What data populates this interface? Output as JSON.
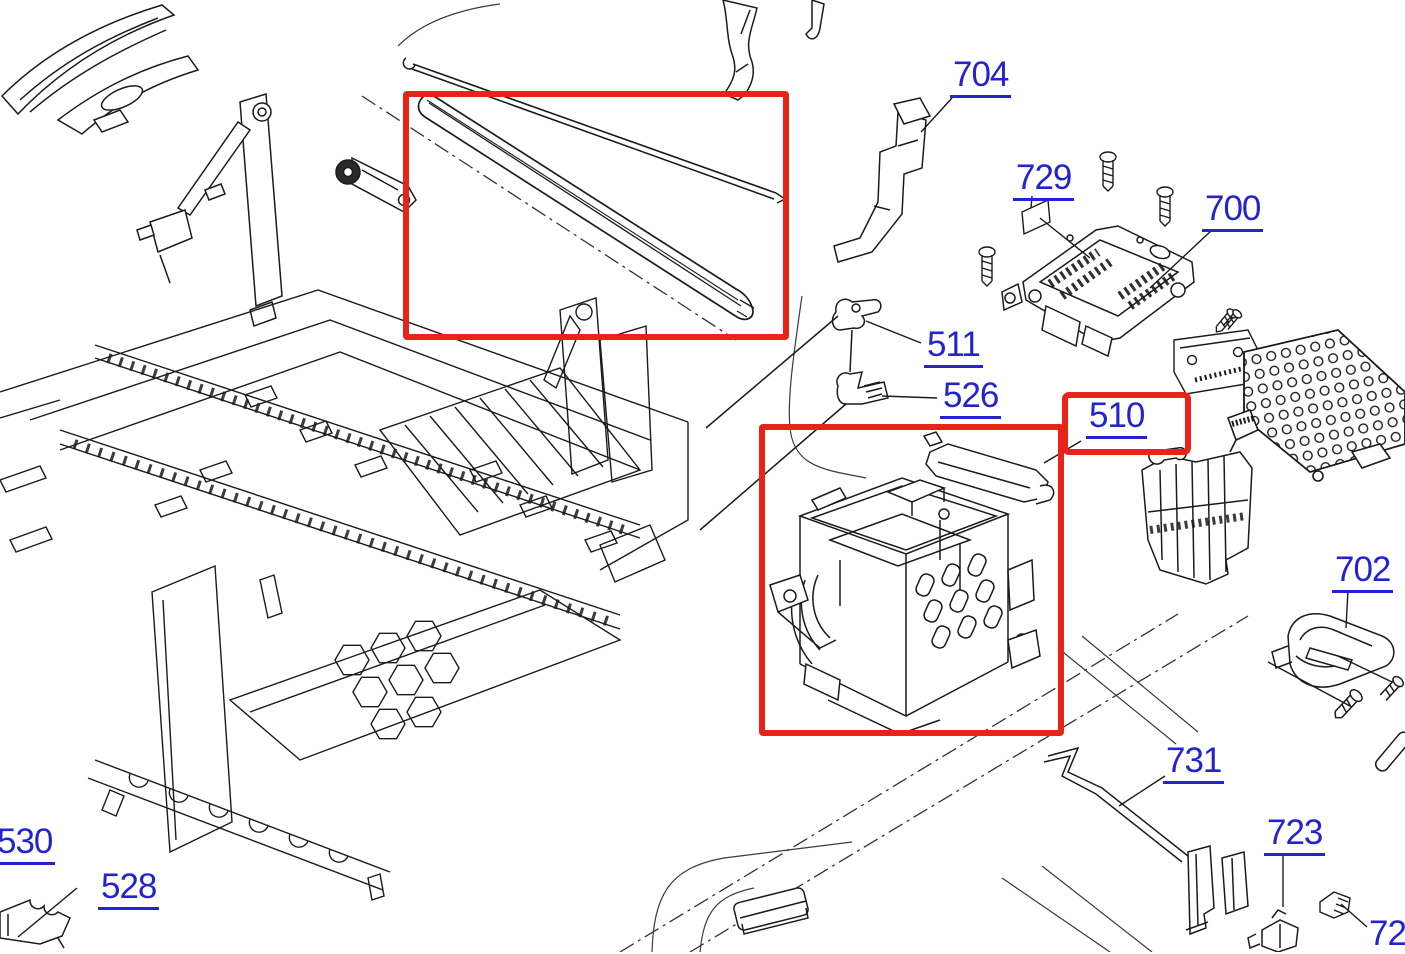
{
  "diagram": {
    "kind": "exploded-parts-diagram",
    "subject": "printer mechanism exploded view with numbered part callouts"
  },
  "colors": {
    "label": "#2323d0",
    "highlight": "#ea2318",
    "line": "#1b1b1b",
    "background": "#ffffff"
  },
  "labels": [
    {
      "id": "704",
      "text": "704"
    },
    {
      "id": "729",
      "text": "729"
    },
    {
      "id": "700",
      "text": "700"
    },
    {
      "id": "511",
      "text": "511"
    },
    {
      "id": "526",
      "text": "526"
    },
    {
      "id": "510",
      "text": "510",
      "highlighted": true
    },
    {
      "id": "702",
      "text": "702"
    },
    {
      "id": "731",
      "text": "731"
    },
    {
      "id": "723",
      "text": "723"
    },
    {
      "id": "530",
      "text": "530"
    },
    {
      "id": "528",
      "text": "528"
    },
    {
      "id": "72",
      "text": "72",
      "note": "clipped at image corner"
    }
  ],
  "highlight_boxes": [
    {
      "name": "belt-and-shaft-highlight"
    },
    {
      "name": "carriage-unit-highlight"
    },
    {
      "name": "label-510-callout"
    }
  ],
  "parts": [
    {
      "name": "paper-feed-guide"
    },
    {
      "name": "release-bracket"
    },
    {
      "name": "main-chassis-frame"
    },
    {
      "name": "belt-tensioner"
    },
    {
      "name": "carriage-timing-belt",
      "highlighted": true
    },
    {
      "name": "carriage-guide-shaft",
      "highlighted": true
    },
    {
      "name": "ffc-guide-film"
    },
    {
      "name": "support-bracket-704"
    },
    {
      "name": "clip-511"
    },
    {
      "name": "detector-flag-526"
    },
    {
      "name": "print-head-700"
    },
    {
      "name": "pad-729"
    },
    {
      "name": "mounting-screws"
    },
    {
      "name": "sensor-board"
    },
    {
      "name": "board-shield-plate"
    },
    {
      "name": "side-frame-bracket"
    },
    {
      "name": "carriage-unit-510",
      "highlighted": true
    },
    {
      "name": "carriage-guide-rail"
    },
    {
      "name": "holder-702"
    },
    {
      "name": "ground-strip-731"
    },
    {
      "name": "sensor-clip-723"
    },
    {
      "name": "connector-clip"
    },
    {
      "name": "corner-guide-part"
    },
    {
      "name": "housing-reference-outlines"
    }
  ]
}
